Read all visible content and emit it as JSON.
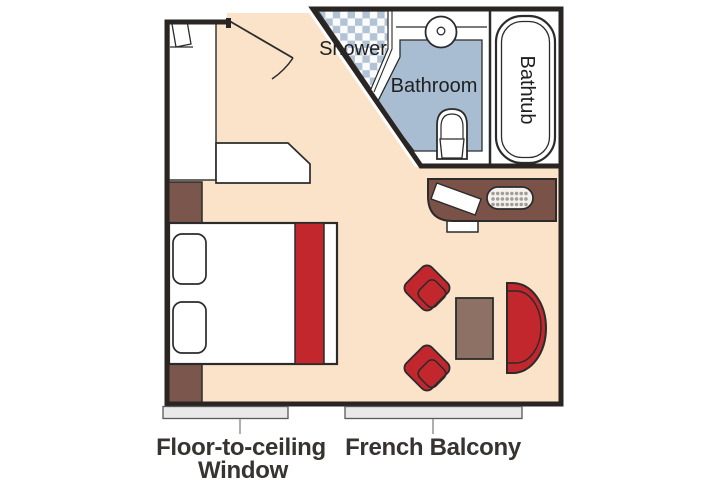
{
  "plan": {
    "rooms": {
      "shower": "Shower",
      "bathroom": "Bathroom",
      "bathtub": "Bathtub"
    },
    "captions": {
      "window_line1": "Floor-to-ceiling",
      "window_line2": "Window",
      "balcony": "French Balcony"
    }
  },
  "colors": {
    "floor": "#fae3c8",
    "wall": "#2a2522",
    "outline": "#2b2b2b",
    "red": "#c1272d",
    "brown": "#7b5248",
    "brown_light": "#8d7164",
    "nightstand": "#7b564c",
    "blue": "#a9bdd2",
    "checker_blue": "#b3c3d6",
    "window_gray": "#e9e9e9",
    "leader": "#9a9a9a",
    "label_text": "#363331"
  }
}
